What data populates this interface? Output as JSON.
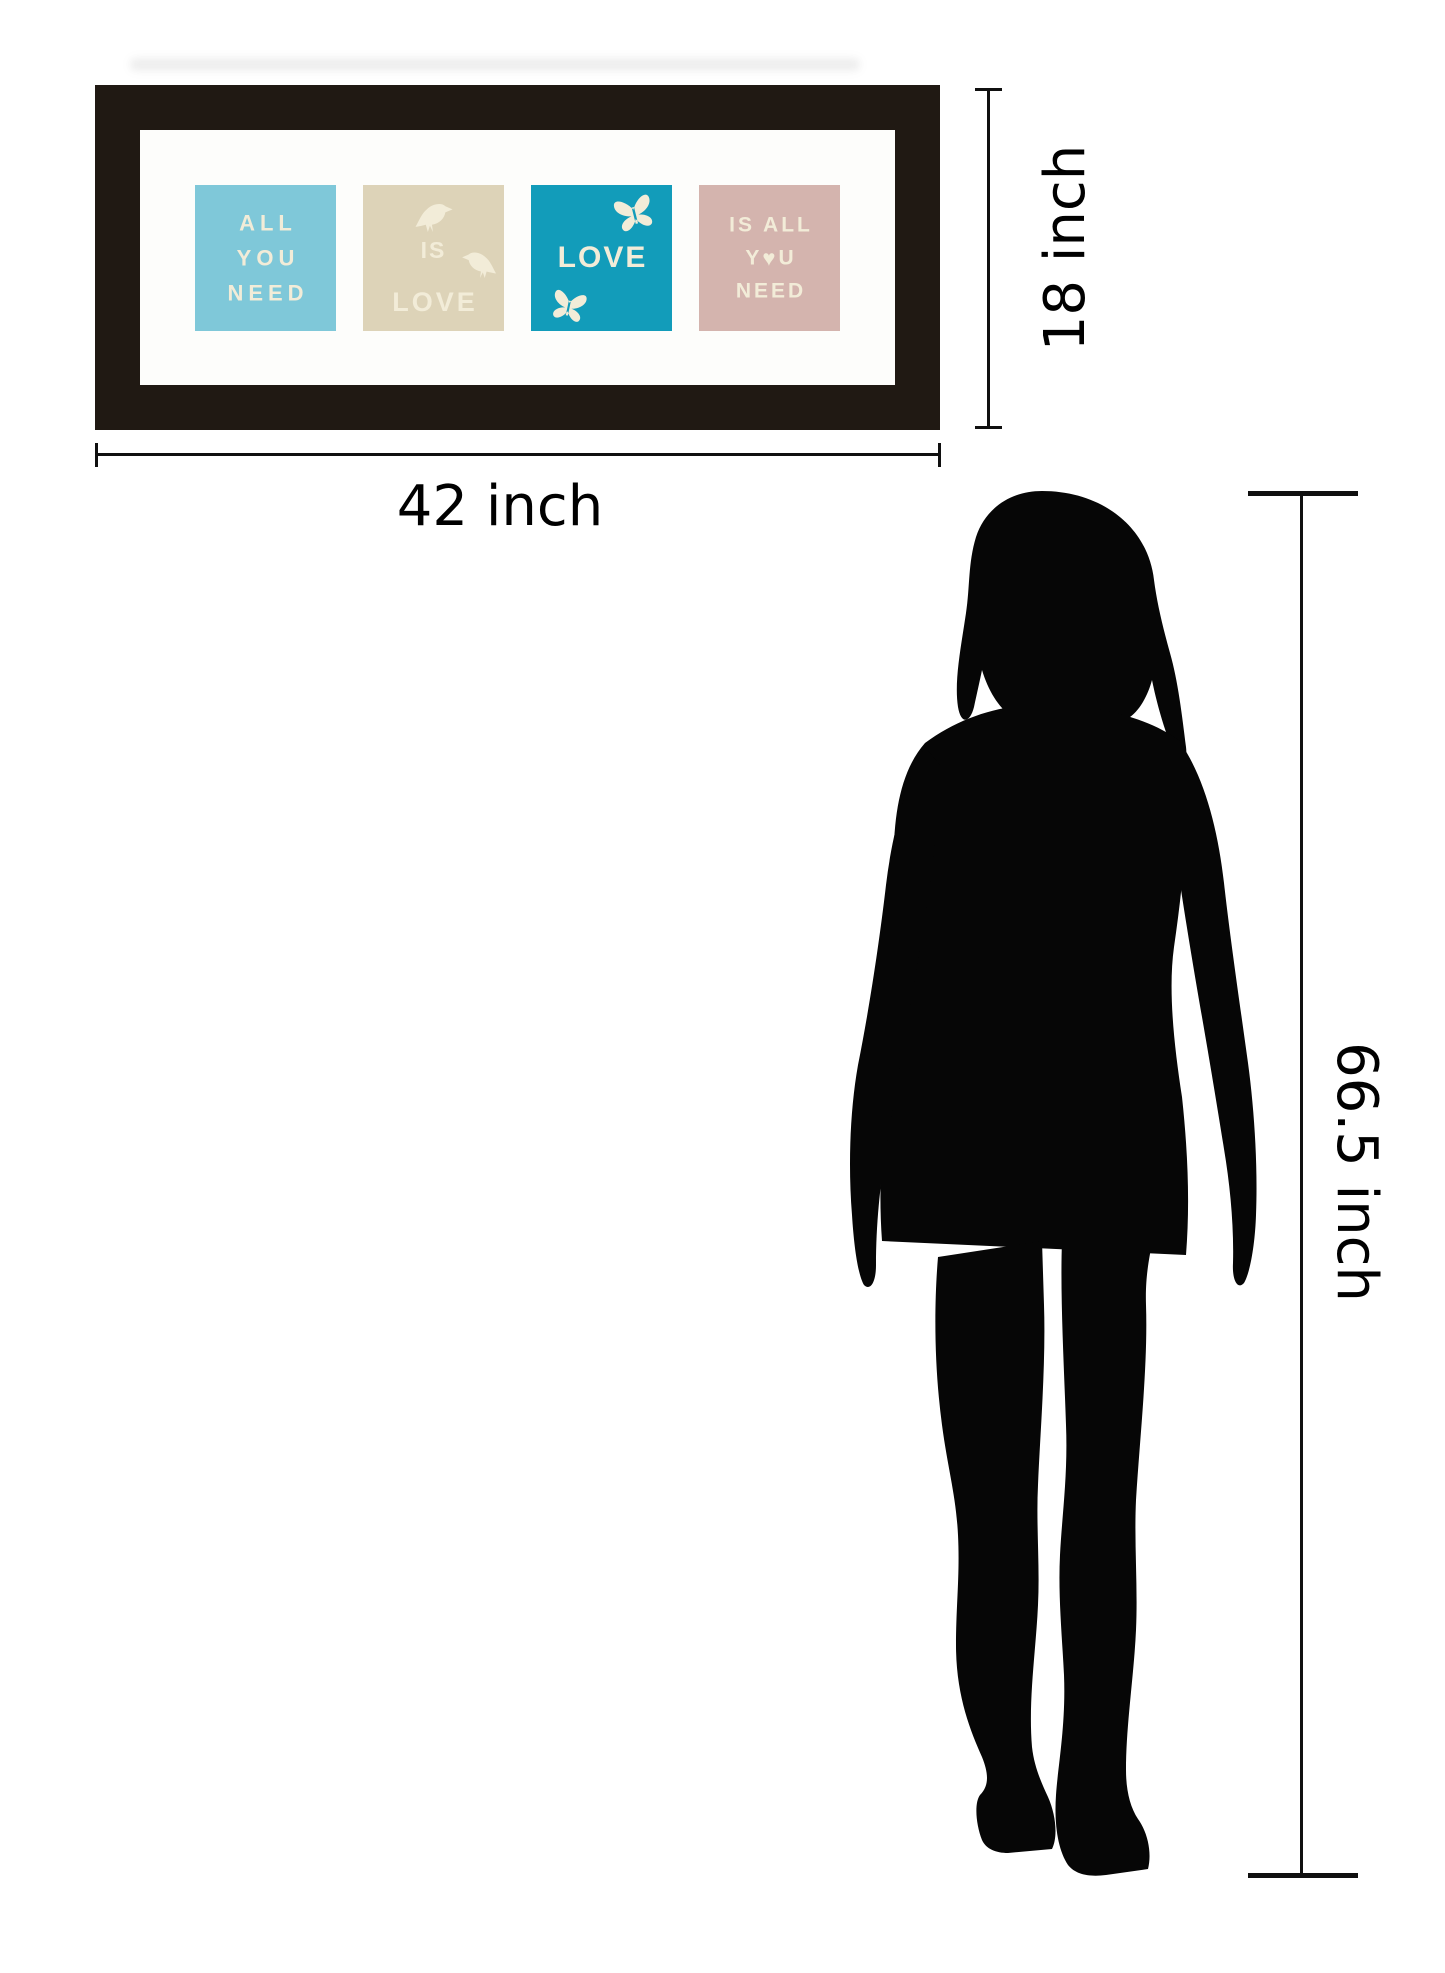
{
  "artwork": {
    "frame_color": "#201913",
    "mat_color": "#fdfdfb",
    "text_color": "#f2ecd8",
    "tiles": [
      {
        "name": "all-you-need",
        "bg": "#7fc8d9",
        "lines": [
          "ALL",
          "YOU",
          "NEED"
        ]
      },
      {
        "name": "is-love-birds",
        "bg": "#ddd3b8",
        "top_word": "IS",
        "bottom_word": "LOVE"
      },
      {
        "name": "love-butterflies",
        "bg": "#129cba",
        "word": "LOVE"
      },
      {
        "name": "is-all-you-need",
        "bg": "#d4b4ae",
        "line1": "IS ALL",
        "line2_left": "Y",
        "heart": "♥",
        "line2_right": "U",
        "line3": "NEED"
      }
    ]
  },
  "dimensions": {
    "width_label": "42 inch",
    "height_label": "18 inch",
    "person_label": "66.5 inch",
    "line_color": "#101010"
  }
}
